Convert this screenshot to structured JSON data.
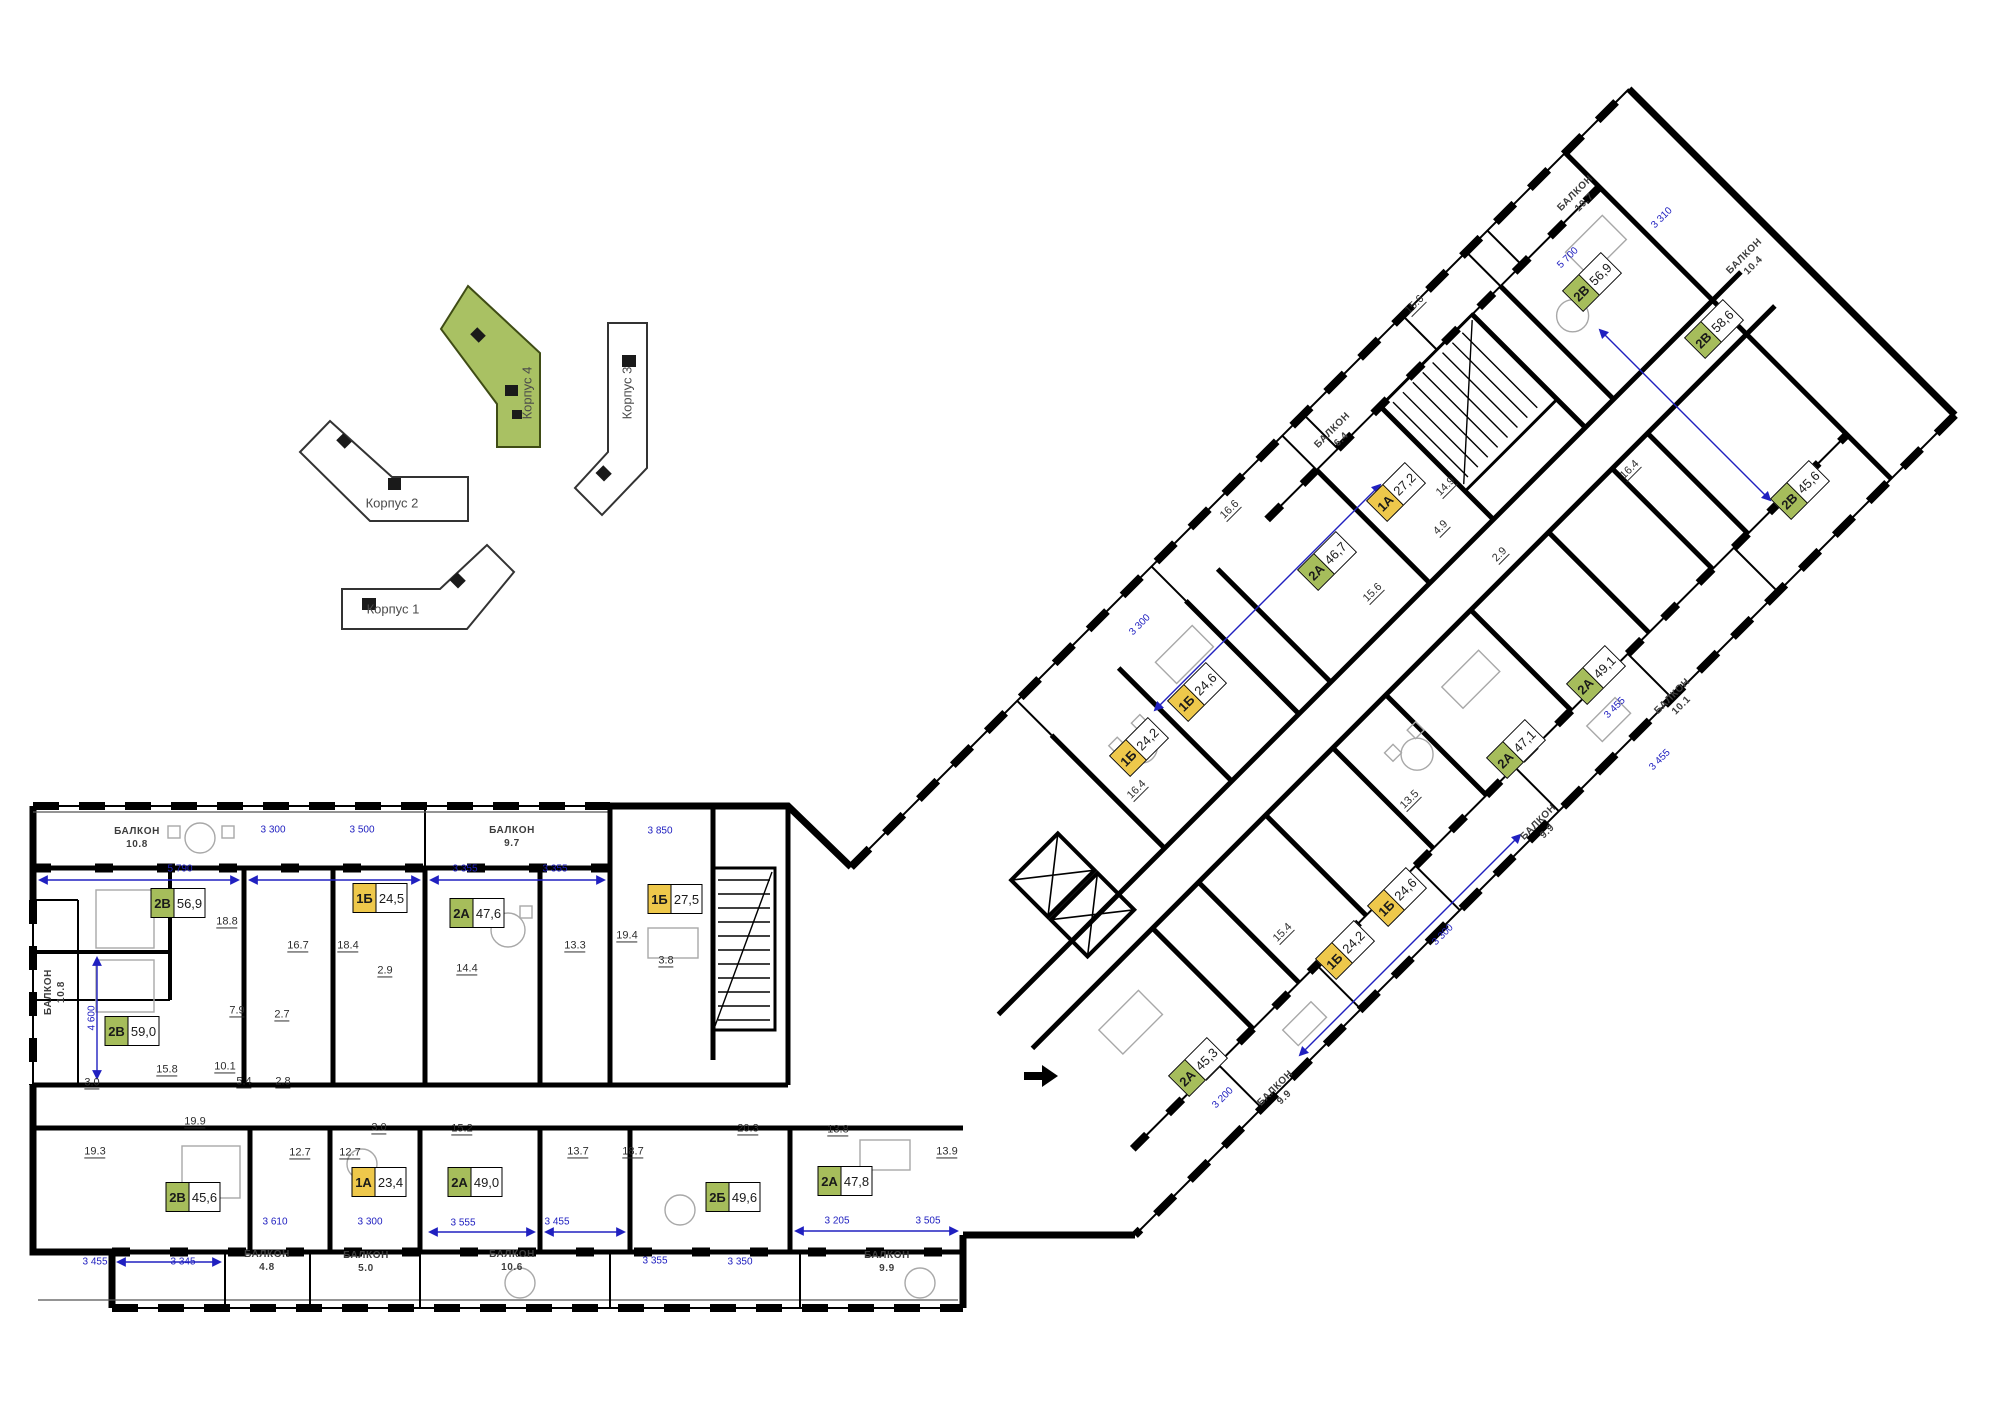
{
  "colors": {
    "green": "#a6bd5b",
    "yellow": "#eec84b",
    "site_green": "#a9c163",
    "wall": "#000000",
    "dim_blue": "#2020c0"
  },
  "site_plan": {
    "buildings": [
      {
        "key": "korpus-4",
        "label": "Корпус 4",
        "highlighted": true,
        "x": 527,
        "y": 393,
        "rot": -90
      },
      {
        "key": "korpus-3",
        "label": "Корпус 3",
        "highlighted": false,
        "x": 627,
        "y": 393,
        "rot": -90
      },
      {
        "key": "korpus-2",
        "label": "Корпус 2",
        "highlighted": false,
        "x": 392,
        "y": 503,
        "rot": 0
      },
      {
        "key": "korpus-1",
        "label": "Корпус 1",
        "highlighted": false,
        "x": 393,
        "y": 609,
        "rot": 0
      }
    ]
  },
  "apartments": [
    {
      "type": "2В",
      "area": "56,9",
      "color": "green",
      "x": 178,
      "y": 903,
      "rot": 0
    },
    {
      "type": "1Б",
      "area": "24,5",
      "color": "yellow",
      "x": 380,
      "y": 898,
      "rot": 0
    },
    {
      "type": "2А",
      "area": "47,6",
      "color": "green",
      "x": 477,
      "y": 913,
      "rot": 0
    },
    {
      "type": "1Б",
      "area": "27,5",
      "color": "yellow",
      "x": 675,
      "y": 899,
      "rot": 0
    },
    {
      "type": "2В",
      "area": "59,0",
      "color": "green",
      "x": 132,
      "y": 1031,
      "rot": 0
    },
    {
      "type": "2В",
      "area": "45,6",
      "color": "green",
      "x": 193,
      "y": 1197,
      "rot": 0
    },
    {
      "type": "1А",
      "area": "23,4",
      "color": "yellow",
      "x": 379,
      "y": 1182,
      "rot": 0
    },
    {
      "type": "2А",
      "area": "49,0",
      "color": "green",
      "x": 475,
      "y": 1182,
      "rot": 0
    },
    {
      "type": "2Б",
      "area": "49,6",
      "color": "green",
      "x": 733,
      "y": 1197,
      "rot": 0
    },
    {
      "type": "2А",
      "area": "47,8",
      "color": "green",
      "x": 845,
      "y": 1181,
      "rot": 0
    },
    {
      "type": "2А",
      "area": "45,3",
      "color": "green",
      "x": 1198,
      "y": 1067,
      "rot": -45
    },
    {
      "type": "1Б",
      "area": "24,2",
      "color": "yellow",
      "x": 1345,
      "y": 950,
      "rot": -45
    },
    {
      "type": "1Б",
      "area": "24,6",
      "color": "yellow",
      "x": 1397,
      "y": 897,
      "rot": -45
    },
    {
      "type": "1Б",
      "area": "24,2",
      "color": "yellow",
      "x": 1139,
      "y": 747,
      "rot": -45
    },
    {
      "type": "1Б",
      "area": "24,6",
      "color": "yellow",
      "x": 1197,
      "y": 692,
      "rot": -45
    },
    {
      "type": "2А",
      "area": "46,7",
      "color": "green",
      "x": 1327,
      "y": 561,
      "rot": -45
    },
    {
      "type": "1А",
      "area": "27,2",
      "color": "yellow",
      "x": 1396,
      "y": 492,
      "rot": -45
    },
    {
      "type": "2А",
      "area": "47,1",
      "color": "green",
      "x": 1516,
      "y": 749,
      "rot": -45
    },
    {
      "type": "2А",
      "area": "49,1",
      "color": "green",
      "x": 1596,
      "y": 675,
      "rot": -45
    },
    {
      "type": "2В",
      "area": "45,6",
      "color": "green",
      "x": 1800,
      "y": 490,
      "rot": -45
    },
    {
      "type": "2В",
      "area": "56,9",
      "color": "green",
      "x": 1592,
      "y": 282,
      "rot": -45
    },
    {
      "type": "2В",
      "area": "58,6",
      "color": "green",
      "x": 1714,
      "y": 329,
      "rot": -45
    }
  ],
  "balconies": [
    {
      "label": "БАЛКОН",
      "area": "10.8",
      "x": 137,
      "y": 838,
      "rot": 0
    },
    {
      "label": "БАЛКОН",
      "area": "9.7",
      "x": 512,
      "y": 837,
      "rot": 0
    },
    {
      "label": "БАЛКОН",
      "area": "10.8",
      "x": 55,
      "y": 992,
      "rot": -90
    },
    {
      "label": "БАЛКОН",
      "area": "4.8",
      "x": 267,
      "y": 1261,
      "rot": 0
    },
    {
      "label": "БАЛКОН",
      "area": "5.0",
      "x": 366,
      "y": 1262,
      "rot": 0
    },
    {
      "label": "БАЛКОН",
      "area": "10.6",
      "x": 512,
      "y": 1261,
      "rot": 0
    },
    {
      "label": "БАЛКОН",
      "area": "9.9",
      "x": 887,
      "y": 1262,
      "rot": 0
    },
    {
      "label": "БАЛКОН",
      "area": "9.9",
      "x": 1280,
      "y": 1093,
      "rot": -45
    },
    {
      "label": "БАЛКОН",
      "area": "9.9",
      "x": 1543,
      "y": 827,
      "rot": -45
    },
    {
      "label": "БАЛКОН",
      "area": "10.1",
      "x": 1677,
      "y": 701,
      "rot": -45
    },
    {
      "label": "БАЛКОН",
      "area": "6.4",
      "x": 1337,
      "y": 435,
      "rot": -45
    },
    {
      "label": "БАЛКОН",
      "area": "10.7",
      "x": 1580,
      "y": 198,
      "rot": -45
    },
    {
      "label": "БАЛКОН",
      "area": "10.4",
      "x": 1749,
      "y": 261,
      "rot": -45
    }
  ],
  "room_areas": [
    {
      "v": "18.8",
      "x": 227,
      "y": 922,
      "rot": 0
    },
    {
      "v": "16.7",
      "x": 298,
      "y": 946,
      "rot": 0
    },
    {
      "v": "18.4",
      "x": 348,
      "y": 946,
      "rot": 0
    },
    {
      "v": "2.9",
      "x": 385,
      "y": 971,
      "rot": 0
    },
    {
      "v": "14.4",
      "x": 467,
      "y": 969,
      "rot": 0
    },
    {
      "v": "13.3",
      "x": 575,
      "y": 946,
      "rot": 0
    },
    {
      "v": "19.4",
      "x": 627,
      "y": 936,
      "rot": 0
    },
    {
      "v": "3.8",
      "x": 666,
      "y": 961,
      "rot": 0
    },
    {
      "v": "7.9",
      "x": 237,
      "y": 1011,
      "rot": 0
    },
    {
      "v": "2.7",
      "x": 282,
      "y": 1015,
      "rot": 0
    },
    {
      "v": "15.8",
      "x": 167,
      "y": 1070,
      "rot": 0
    },
    {
      "v": "10.1",
      "x": 225,
      "y": 1067,
      "rot": 0
    },
    {
      "v": "5.4",
      "x": 244,
      "y": 1082,
      "rot": 0
    },
    {
      "v": "2.8",
      "x": 283,
      "y": 1082,
      "rot": 0
    },
    {
      "v": "3.0",
      "x": 92,
      "y": 1083,
      "rot": 0
    },
    {
      "v": "19.9",
      "x": 195,
      "y": 1122,
      "rot": 0
    },
    {
      "v": "19.3",
      "x": 95,
      "y": 1152,
      "rot": 0
    },
    {
      "v": "12.7",
      "x": 300,
      "y": 1153,
      "rot": 0
    },
    {
      "v": "12.7",
      "x": 350,
      "y": 1153,
      "rot": 0
    },
    {
      "v": "3.0",
      "x": 379,
      "y": 1128,
      "rot": 0
    },
    {
      "v": "15.2",
      "x": 462,
      "y": 1129,
      "rot": 0
    },
    {
      "v": "13.7",
      "x": 578,
      "y": 1152,
      "rot": 0
    },
    {
      "v": "18.7",
      "x": 633,
      "y": 1152,
      "rot": 0
    },
    {
      "v": "20.3",
      "x": 748,
      "y": 1129,
      "rot": 0
    },
    {
      "v": "13.8",
      "x": 838,
      "y": 1130,
      "rot": 0
    },
    {
      "v": "13.9",
      "x": 947,
      "y": 1152,
      "rot": 0
    },
    {
      "v": "16.4",
      "x": 1137,
      "y": 790,
      "rot": -45
    },
    {
      "v": "15.4",
      "x": 1283,
      "y": 933,
      "rot": -45
    },
    {
      "v": "15.6",
      "x": 1373,
      "y": 593,
      "rot": -45
    },
    {
      "v": "14.9",
      "x": 1446,
      "y": 487,
      "rot": -45
    },
    {
      "v": "4.9",
      "x": 1441,
      "y": 528,
      "rot": -45
    },
    {
      "v": "2.9",
      "x": 1500,
      "y": 555,
      "rot": -45
    },
    {
      "v": "13.5",
      "x": 1410,
      "y": 800,
      "rot": -45
    },
    {
      "v": "16.6",
      "x": 1230,
      "y": 510,
      "rot": -45
    },
    {
      "v": "15.6",
      "x": 1415,
      "y": 305,
      "rot": -45
    },
    {
      "v": "16.4",
      "x": 1630,
      "y": 470,
      "rot": -45
    }
  ],
  "dimensions": [
    {
      "v": "5 790",
      "x": 180,
      "y": 869,
      "rot": 0
    },
    {
      "v": "3 300",
      "x": 273,
      "y": 830,
      "rot": 0
    },
    {
      "v": "3 500",
      "x": 362,
      "y": 830,
      "rot": 0
    },
    {
      "v": "3 355",
      "x": 465,
      "y": 869,
      "rot": 0
    },
    {
      "v": "3 355",
      "x": 555,
      "y": 869,
      "rot": 0
    },
    {
      "v": "3 850",
      "x": 660,
      "y": 831,
      "rot": 0
    },
    {
      "v": "4 600",
      "x": 92,
      "y": 1018,
      "rot": -90
    },
    {
      "v": "3 455",
      "x": 95,
      "y": 1262,
      "rot": 0
    },
    {
      "v": "3 345",
      "x": 183,
      "y": 1262,
      "rot": 0
    },
    {
      "v": "3 610",
      "x": 275,
      "y": 1222,
      "rot": 0
    },
    {
      "v": "3 300",
      "x": 370,
      "y": 1222,
      "rot": 0
    },
    {
      "v": "3 555",
      "x": 463,
      "y": 1223,
      "rot": 0
    },
    {
      "v": "3 455",
      "x": 557,
      "y": 1222,
      "rot": 0
    },
    {
      "v": "3 355",
      "x": 655,
      "y": 1261,
      "rot": 0
    },
    {
      "v": "3 350",
      "x": 740,
      "y": 1262,
      "rot": 0
    },
    {
      "v": "3 205",
      "x": 837,
      "y": 1221,
      "rot": 0
    },
    {
      "v": "3 505",
      "x": 928,
      "y": 1221,
      "rot": 0
    },
    {
      "v": "3 300",
      "x": 1140,
      "y": 625,
      "rot": -45
    },
    {
      "v": "3 455",
      "x": 1615,
      "y": 708,
      "rot": -45
    },
    {
      "v": "3 300",
      "x": 1443,
      "y": 935,
      "rot": -45
    },
    {
      "v": "3 200",
      "x": 1223,
      "y": 1098,
      "rot": -45
    },
    {
      "v": "5 700",
      "x": 1568,
      "y": 258,
      "rot": -45
    },
    {
      "v": "3 310",
      "x": 1662,
      "y": 218,
      "rot": -45
    },
    {
      "v": "3 455",
      "x": 1660,
      "y": 760,
      "rot": -45
    }
  ]
}
